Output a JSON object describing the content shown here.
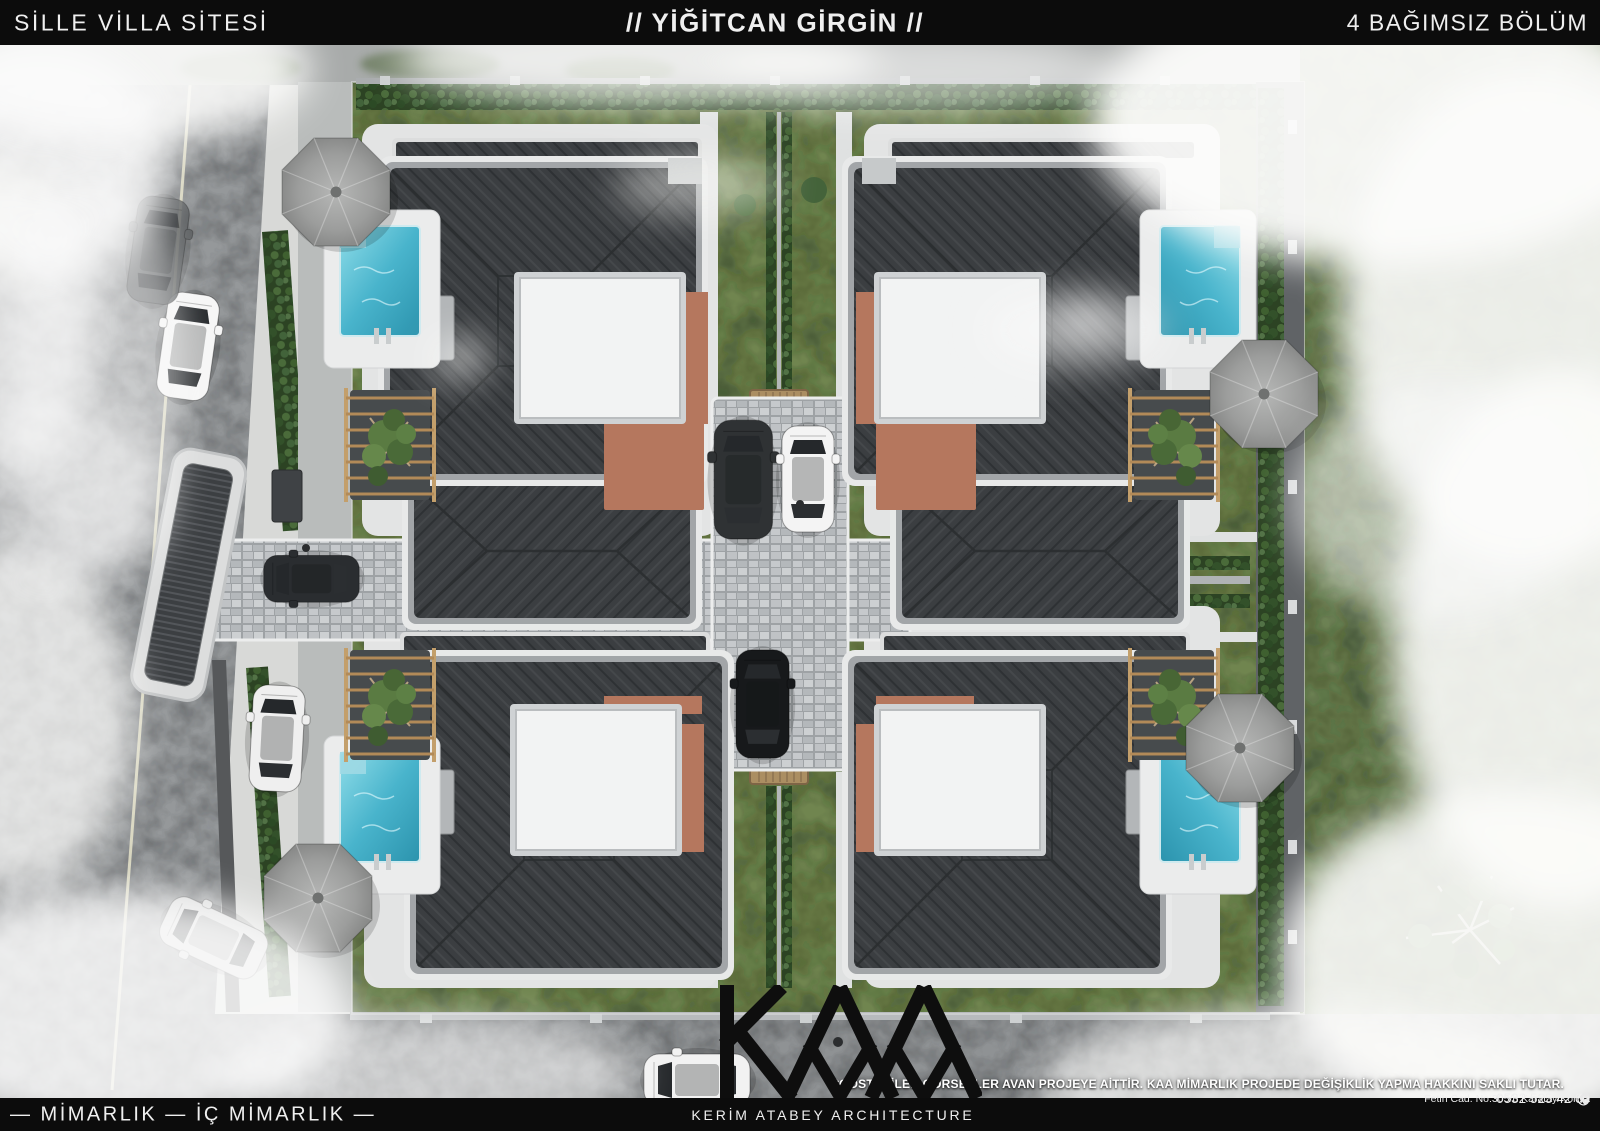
{
  "header": {
    "left": "SİLLE VİLLA SİTESİ",
    "center": "// YİĞİTCAN GİRGİN //",
    "right": "4 BAĞIMSIZ BÖLÜM"
  },
  "footer": {
    "left": "—  MİMARLIK  —  İÇ MİMARLIK —",
    "brand": "KERİM ATABEY ARCHITECTURE",
    "logo": "KAA"
  },
  "disclaimer": "*GÖSTERİLEN GÖRSELLER AVAN PROJEYE AİTTİR. KAA MİMARLIK PROJEDE DEĞİŞİKLİK YAPMA HAKKINI SAKLI TUTAR.",
  "contact": {
    "phone": "0532 525 42 00",
    "address": "Fetih Cad. No:305/b Karatay/Konya"
  },
  "scene": {
    "description": "Aerial 3D render of villa site with 4 detached villas, pools, umbrellas, cobblestone cross road, hedges, parked cars and fog",
    "villa_count": 4
  },
  "colors": {
    "bar": "#0c0c0c",
    "grass": "#70854f",
    "lawn": "#6b8052",
    "roof": "#3b3e41",
    "terracotta": "#b5775e",
    "pool": "#49b4cc",
    "concrete": "#e3e4e4",
    "cobble": "#9ea2a5",
    "hedge": "#2c4323",
    "umbrella": "#a0a19f",
    "asphalt": "#95989a"
  }
}
